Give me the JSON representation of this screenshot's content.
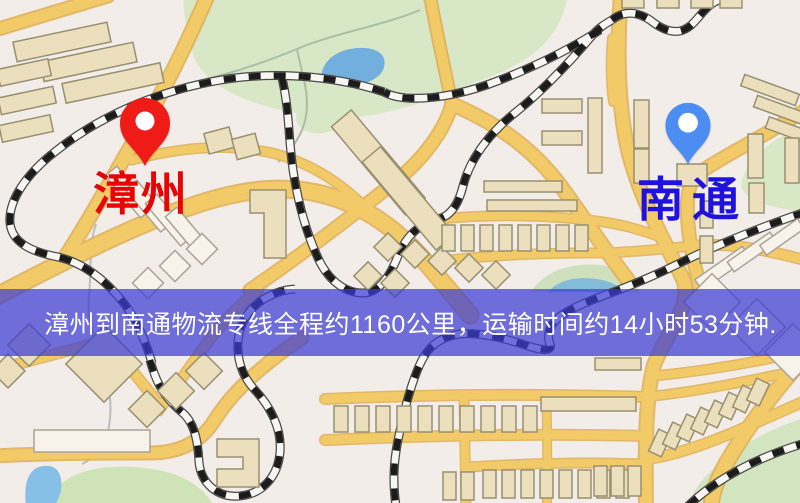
{
  "window": {
    "width_px": 800,
    "height_px": 503
  },
  "map": {
    "type": "static-route-map",
    "markers": [
      {
        "id": "origin",
        "label": "漳州",
        "pin_color": "#ee1b17",
        "label_color": "#e60404",
        "pin_icon": "red-location-pin"
      },
      {
        "id": "destination",
        "label": "南通",
        "pin_color": "#4b8df2",
        "label_color": "#2012dd",
        "pin_icon": "blue-location-pin"
      }
    ]
  },
  "banner": {
    "text": "漳州到南通物流专线全程约1160公里，运输时间约14小时53分钟.",
    "background_color": "#3c3cd2",
    "text_color": "#ffffff"
  },
  "route": {
    "origin": "漳州",
    "destination": "南通",
    "distance_text": "全程约1160公里",
    "duration_text": "运输时间约14小时53分钟"
  },
  "map_palette": {
    "background": "#f3edea",
    "road": "#f2cb68",
    "road_casing": "#dfae52",
    "park": "#d8e7c6",
    "water": "#72aede",
    "railway": "#1d1d1d",
    "building": "#ebdfbe",
    "building_light": "#f7f3ea"
  }
}
